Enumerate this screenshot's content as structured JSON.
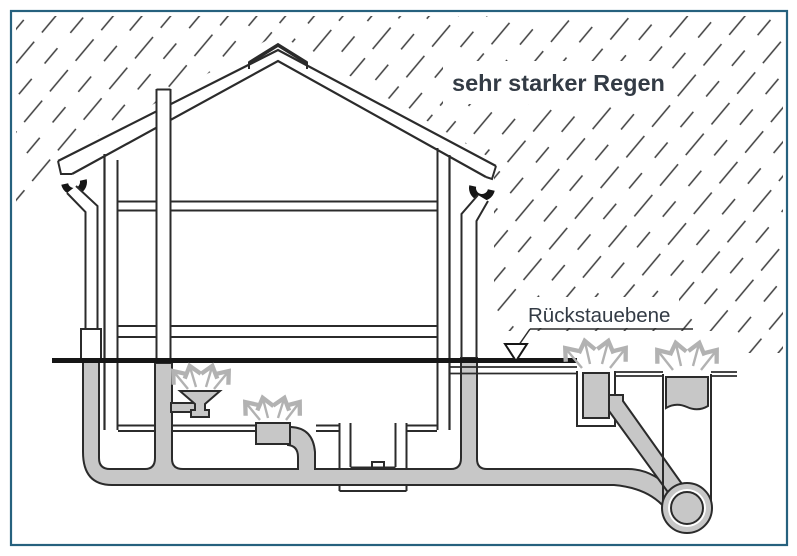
{
  "diagram": {
    "rain_label": "sehr starker Regen",
    "backflow_label": "Rückstauebene"
  },
  "colors": {
    "background": "#ffffff",
    "border": "#26617e",
    "line": "#2b2b2b",
    "black": "#161616",
    "pipe": "#c7c7c7",
    "spray": "#b2b2b2",
    "text": "#333b45",
    "rain": "#3c3c3c"
  }
}
